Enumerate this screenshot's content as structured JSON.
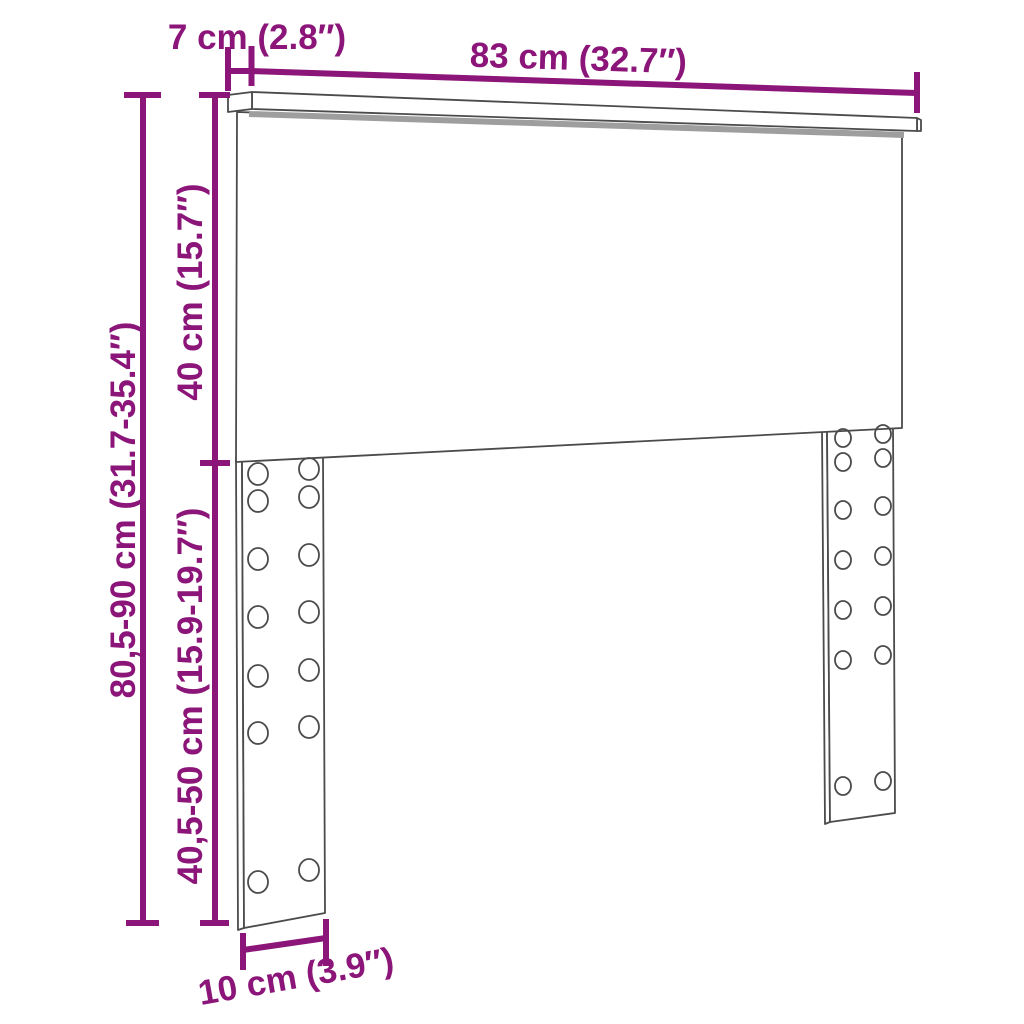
{
  "diagram": {
    "dimensions": {
      "shelf_depth": "7 cm (2.8″)",
      "width": "83 cm (32.7″)",
      "upper_height": "40 cm (15.7″)",
      "total_height": "80,5-90 cm (31.7-35.4″)",
      "leg_height": "40,5-50 cm (15.9-19.7″)",
      "leg_width": "10 cm (3.9″)"
    },
    "colors": {
      "accent": "#8B1578",
      "outline": "#4B4B4B",
      "shadow": "#9E9E9E",
      "background": "#FFFFFF"
    }
  }
}
